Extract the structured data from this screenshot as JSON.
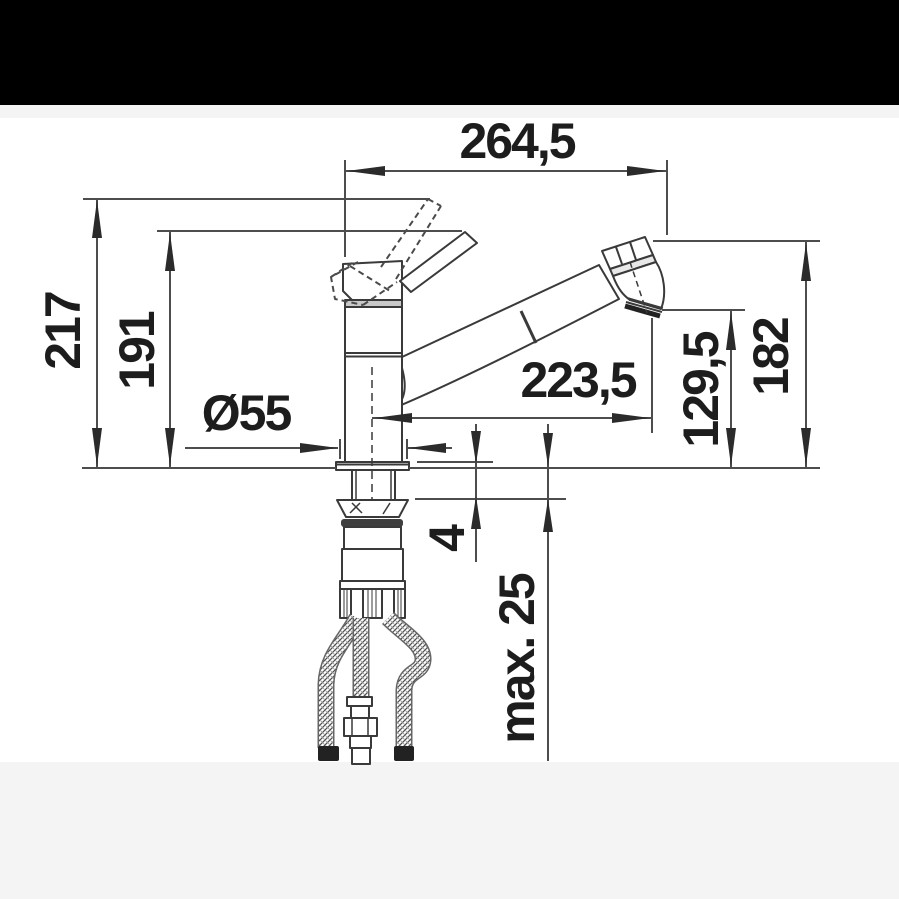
{
  "colors": {
    "header_bar": "#000000",
    "side_bands": "#f4f4f4",
    "canvas": "#ffffff",
    "drawing_lines": "#4d4d4d",
    "arrows_and_text": "#1d1d1d"
  },
  "dimensions": {
    "overall_width": "264,5",
    "height_to_lever_tip": "217",
    "height_to_spout_body": "191",
    "base_diameter": "Ø55",
    "spout_reach": "223,5",
    "outlet_height": "129,5",
    "head_top_height": "182",
    "flange_gap": "4",
    "max_deck_thickness": "max. 25"
  }
}
